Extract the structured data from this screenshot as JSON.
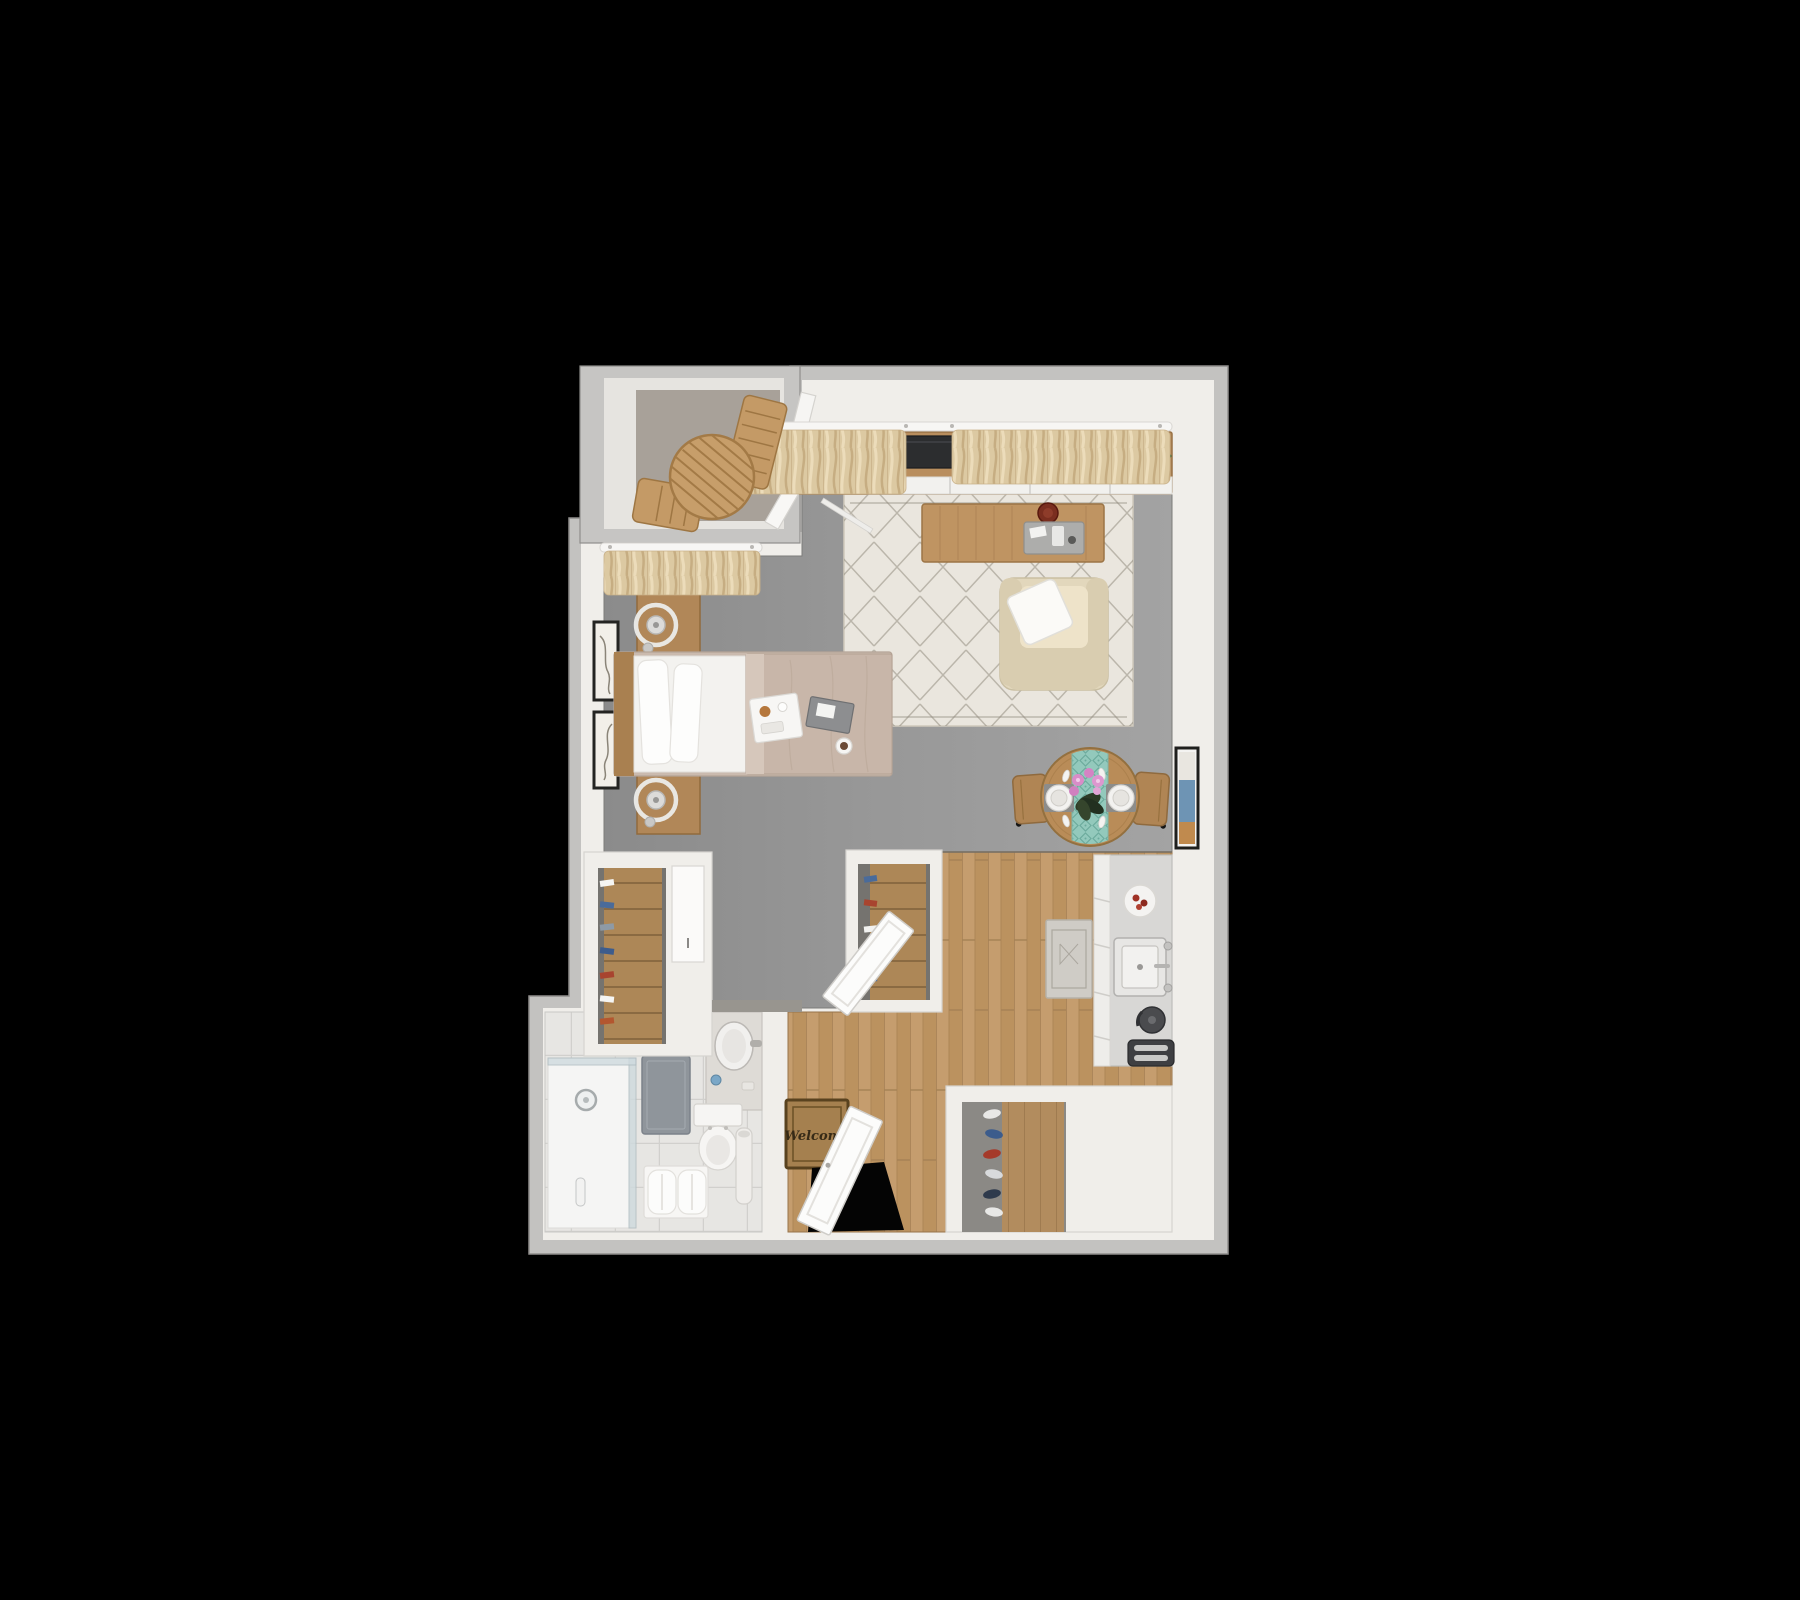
{
  "scene": {
    "description": "3D rendered top-down floor plan of a studio apartment on black background",
    "background_color": "#000000"
  },
  "entry": {
    "mat_text": "Welcome"
  },
  "palette": {
    "wall_top": "#f0eeea",
    "wall_edge": "#c3c2c0",
    "carpet_floor": "#989898",
    "wood_floor": "#c59d6e",
    "balcony_floor": "#a8a199",
    "area_rug": "#eae6de",
    "curtains": "#dcc9a2",
    "furniture_wood": "#b98e5e",
    "tv_screen": "#2c2d2f",
    "table_runner": "#93c9bc",
    "orchid": "#d98cc8",
    "bath_tile": "#e7e6e3",
    "bath_mat": "#8f959b",
    "welcome_mat": "#a5804f"
  },
  "rooms": [
    {
      "name": "balcony",
      "items": [
        "round-slatted-patio-table",
        "patio-chair",
        "patio-chair"
      ]
    },
    {
      "name": "living-room",
      "items": [
        "window-curtains",
        "media-console",
        "tv",
        "magazine-stack",
        "potted-aloe-plant",
        "diamond-area-rug",
        "coffee-table",
        "serving-tray",
        "decor-bowl",
        "armchair",
        "throw-pillow",
        "sliding-glass-door"
      ]
    },
    {
      "name": "sleeping-area",
      "items": [
        "window-curtains",
        "wall-art-frame",
        "wall-art-frame",
        "nightstand-with-ring-lamp",
        "nightstand-with-ring-lamp",
        "bed",
        "breakfast-tray",
        "tablet",
        "mug",
        "wardrobe-closet"
      ]
    },
    {
      "name": "dining-nook",
      "items": [
        "round-dining-table",
        "teal-table-runner",
        "place-setting",
        "place-setting",
        "orchid-centerpiece",
        "dining-chair",
        "dining-chair",
        "wall-art"
      ]
    },
    {
      "name": "kitchen",
      "items": [
        "counter-with-drawers",
        "sink",
        "faucet",
        "plate-with-food",
        "kettle",
        "toaster",
        "runner-rug"
      ]
    },
    {
      "name": "entry",
      "items": [
        "welcome-mat",
        "open-front-door",
        "coat-closet",
        "shoe-closet"
      ]
    },
    {
      "name": "bathroom",
      "items": [
        "walk-in-shower",
        "shower-head",
        "bath-mat",
        "vanity-sink",
        "toilet",
        "towel-bench",
        "floor-vase",
        "open-bathroom-door"
      ]
    }
  ]
}
